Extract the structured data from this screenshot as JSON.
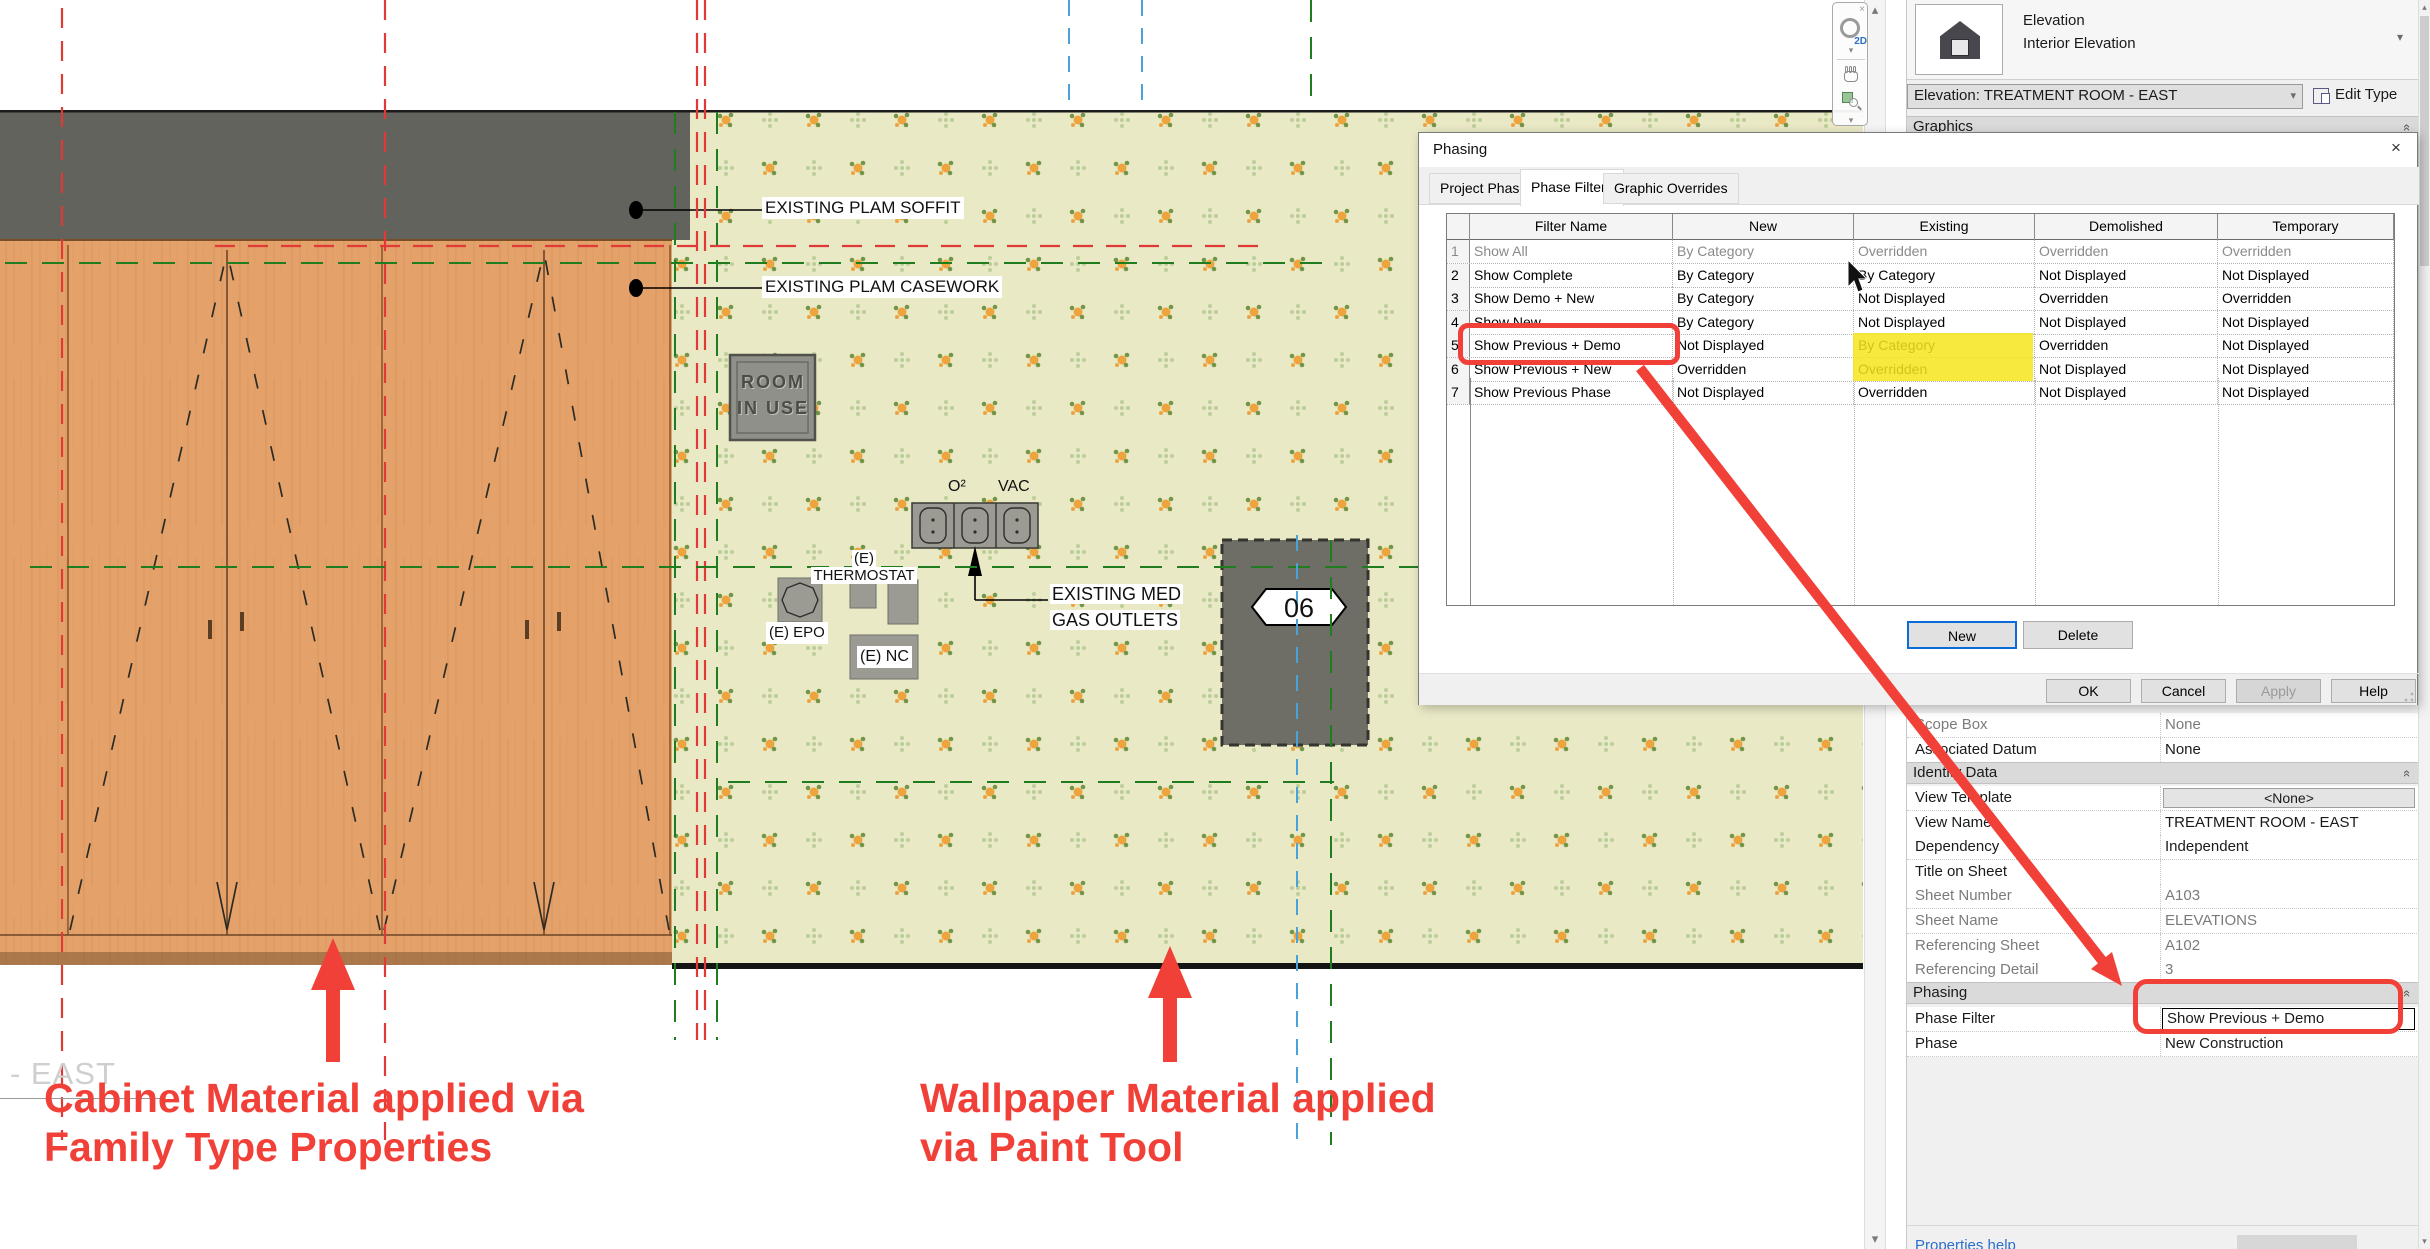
{
  "icons": {
    "close": "×",
    "dropdown": "▾",
    "combo_chevron": "▾",
    "collapse_up": "«",
    "scroll_up": "▴",
    "scroll_down": "▾",
    "nav_2d": "2D"
  },
  "colors": {
    "annotation_red": "#f04038",
    "highlight_yellow": "#f6e51c",
    "cabinet_orange": "#e4a26a",
    "wallpaper_bg": "#eae9c6",
    "soffit_gray": "#63635d"
  },
  "canvas": {
    "labels": {
      "soffit": "EXISTING PLAM SOFFIT",
      "casework": "EXISTING PLAM CASEWORK",
      "o2": "O²",
      "vac": "VAC",
      "thermostat_line1": "(E)",
      "thermostat_line2": "THERMOSTAT",
      "epo": "(E) EPO",
      "nc": "(E) NC",
      "medgas_line1": "EXISTING MED",
      "medgas_line2": "GAS OUTLETS",
      "room_sign_line1": "ROOM",
      "room_sign_line2": "IN USE",
      "door_tag": "06"
    },
    "view_title": "- EAST"
  },
  "notes": {
    "cabinet_line1": "Cabinet Material applied via",
    "cabinet_line2": "Family Type Properties",
    "wallpaper_line1": "Wallpaper Material applied",
    "wallpaper_line2": "via Paint Tool"
  },
  "dialog": {
    "title": "Phasing",
    "tabs": [
      {
        "label": "Project Phases"
      },
      {
        "label": "Phase Filters"
      },
      {
        "label": "Graphic Overrides"
      }
    ],
    "table": {
      "columns": [
        "",
        "Filter Name",
        "New",
        "Existing",
        "Demolished",
        "Temporary"
      ],
      "rows": [
        {
          "num": "1",
          "name": "Show All",
          "new": "By Category",
          "existing": "Overridden",
          "demolished": "Overridden",
          "temporary": "Overridden"
        },
        {
          "num": "2",
          "name": "Show Complete",
          "new": "By Category",
          "existing": "By Category",
          "demolished": "Not Displayed",
          "temporary": "Not Displayed"
        },
        {
          "num": "3",
          "name": "Show Demo + New",
          "new": "By Category",
          "existing": "Not Displayed",
          "demolished": "Overridden",
          "temporary": "Overridden"
        },
        {
          "num": "4",
          "name": "Show New",
          "new": "By Category",
          "existing": "Not Displayed",
          "demolished": "Not Displayed",
          "temporary": "Not Displayed"
        },
        {
          "num": "5",
          "name": "Show Previous + Demo",
          "new": "Not Displayed",
          "existing": "By Category",
          "demolished": "Overridden",
          "temporary": "Not Displayed"
        },
        {
          "num": "6",
          "name": "Show Previous + New",
          "new": "Overridden",
          "existing": "Overridden",
          "demolished": "Not Displayed",
          "temporary": "Not Displayed"
        },
        {
          "num": "7",
          "name": "Show Previous Phase",
          "new": "Not Displayed",
          "existing": "Overridden",
          "demolished": "Not Displayed",
          "temporary": "Not Displayed"
        }
      ]
    },
    "buttons": {
      "new": "New",
      "delete": "Delete",
      "ok": "OK",
      "cancel": "Cancel",
      "apply": "Apply",
      "help": "Help"
    }
  },
  "properties": {
    "type_selector": {
      "family": "Elevation",
      "type": "Interior Elevation"
    },
    "instance_combo": "Elevation: TREATMENT ROOM - EAST",
    "edit_type": "Edit Type",
    "graphics_header": "Graphics",
    "rows": [
      {
        "label": "Scope Box",
        "value": "None"
      },
      {
        "label": "Associated Datum",
        "value": "None"
      },
      {
        "label": "Identity Data",
        "value": ""
      },
      {
        "label": "View Template",
        "value": "<None>"
      },
      {
        "label": "View Name",
        "value": "TREATMENT ROOM - EAST"
      },
      {
        "label": "Dependency",
        "value": "Independent"
      },
      {
        "label": "Title on Sheet",
        "value": ""
      },
      {
        "label": "Sheet Number",
        "value": "A103"
      },
      {
        "label": "Sheet Name",
        "value": "ELEVATIONS"
      },
      {
        "label": "Referencing Sheet",
        "value": "A102"
      },
      {
        "label": "Referencing Detail",
        "value": "3"
      },
      {
        "label": "Phasing",
        "value": ""
      },
      {
        "label": "Phase Filter",
        "value": "Show Previous + Demo"
      },
      {
        "label": "Phase",
        "value": "New Construction"
      }
    ],
    "help_link": "Properties help"
  }
}
